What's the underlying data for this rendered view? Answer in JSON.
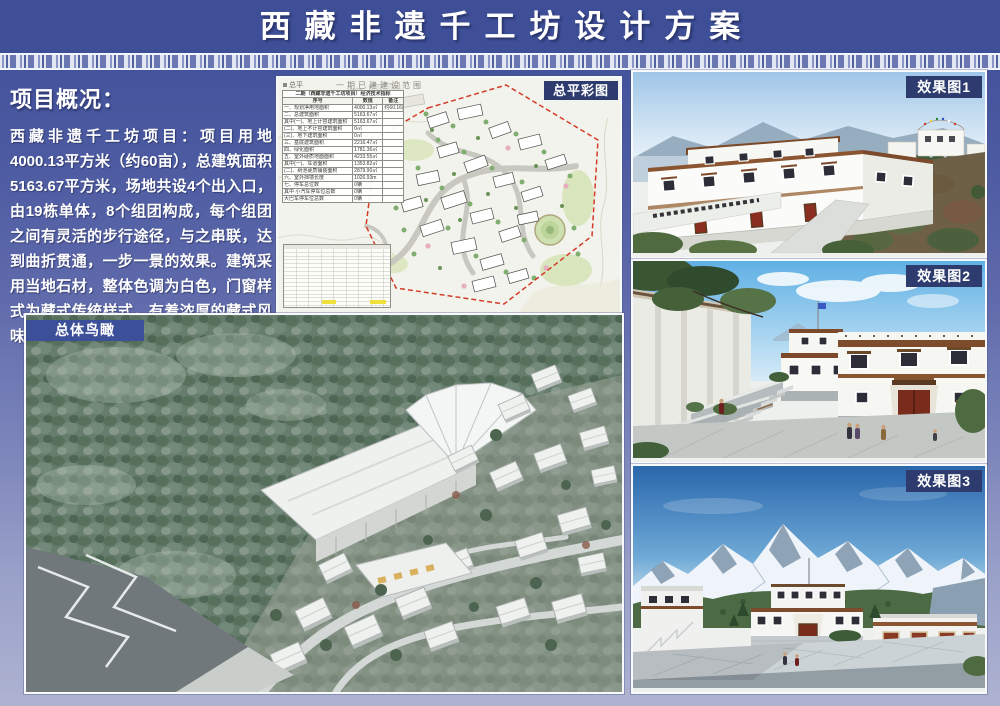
{
  "header": {
    "title": "西藏非遗千工坊设计方案"
  },
  "overview": {
    "heading": "项目概况：",
    "body": "西藏非遗千工坊项目：项目用地4000.13平方米（约60亩），总建筑面积5163.67平方米，场地共设4个出入口，由19栋单体，8个组团构成，每个组团之间有灵活的步行途径，与之串联，达到曲折贯通，一步一景的效果。建筑采用当地石材，整体色调为白色，门窗样式为藏式传统样式，有着浓厚的藏式风味，符合片区的整体风貌。"
  },
  "panels": {
    "site_plan": {
      "label": "总平彩图",
      "map_title": "一期已建建设范围",
      "legend": "总平",
      "indicator_table": {
        "title": "二期（西藏非遗千工坊项目）经济技术指标",
        "columns": [
          "序号",
          "数值",
          "备注"
        ],
        "rows": [
          [
            "一、规划净用地面积",
            "4000.13㎡",
            "约60.16亩"
          ],
          [
            "二、总建筑面积",
            "5163.67㎡",
            ""
          ],
          [
            "其中(一)、地上计容建筑面积",
            "5163.67㎡",
            ""
          ],
          [
            "(二)、地上不计容建筑面积",
            "0㎡",
            ""
          ],
          [
            "(三)、地下建筑面积",
            "0㎡",
            ""
          ],
          [
            "三、基底建筑面积",
            "2216.47㎡",
            ""
          ],
          [
            "四、绿化面积",
            "1781.36㎡",
            ""
          ],
          [
            "五、室外硬质地面面积",
            "4233.55㎡",
            ""
          ],
          [
            "其中(一)、车道面积",
            "1353.82㎡",
            ""
          ],
          [
            "(二)、树池硬质铺装面积",
            "2879.90㎡",
            ""
          ],
          [
            "六、室外挡墙长度",
            "1026.93m",
            ""
          ],
          [
            "七、停车总位数",
            "0辆",
            ""
          ],
          [
            "其中 小汽车停车位总数",
            "0辆",
            ""
          ],
          [
            "大巴车停车位总数",
            "0辆",
            ""
          ]
        ]
      }
    },
    "aerial": {
      "label": "总体鸟瞰"
    },
    "render1": {
      "label": "效果图1"
    },
    "render2": {
      "label": "效果图2"
    },
    "render3": {
      "label": "效果图3"
    }
  },
  "colors": {
    "header_bg": "#3E4F98",
    "page_bottom": "#AEB3D1",
    "tag_navy": "#2D3B6E",
    "tag_blue": "#3C4F99",
    "boundary_red": "#D43C28"
  }
}
